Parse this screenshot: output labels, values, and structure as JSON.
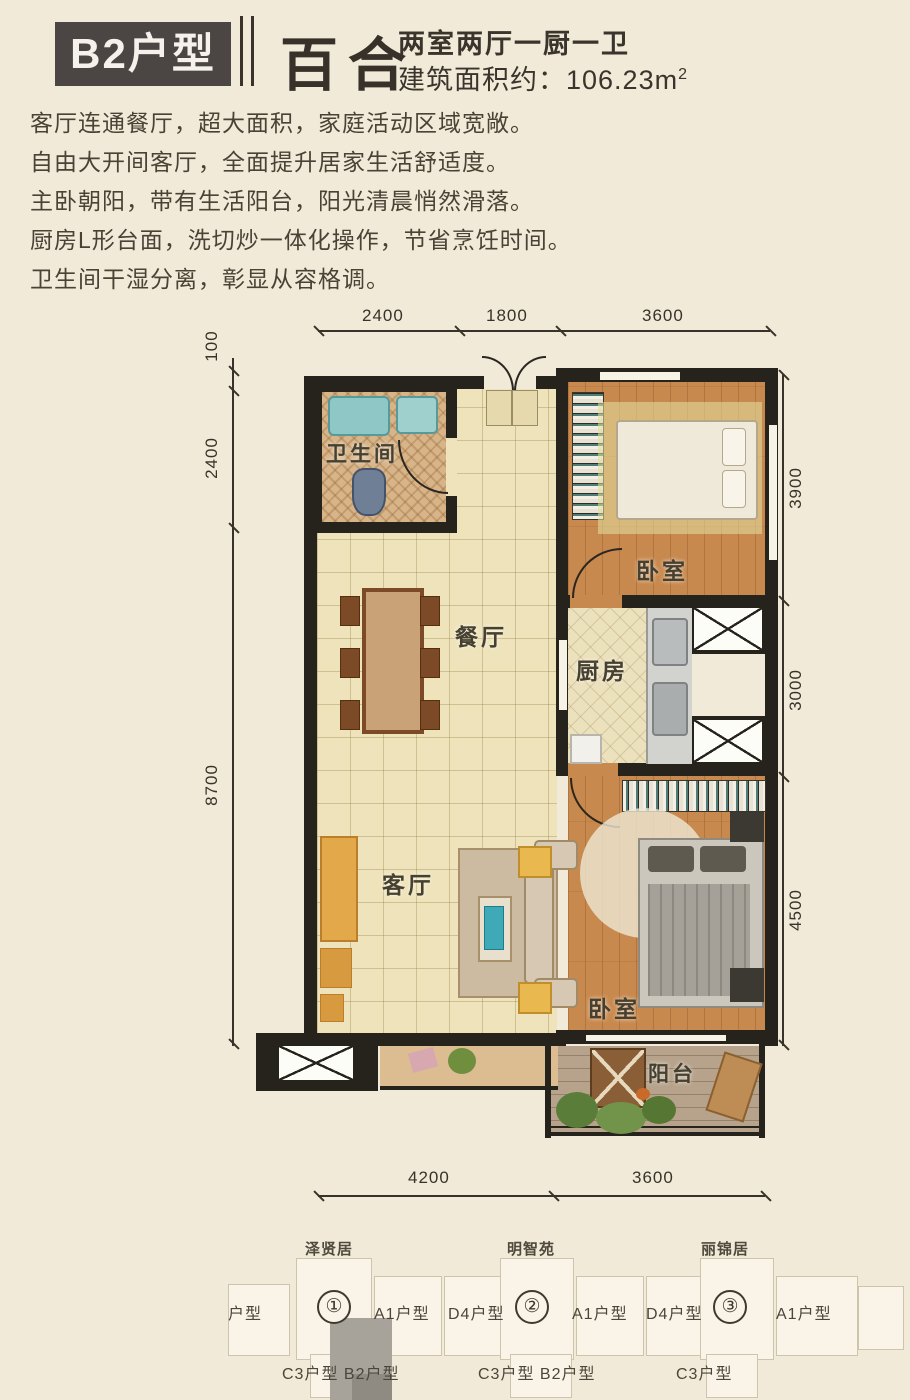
{
  "header": {
    "badge": "B2户型",
    "name": "百合",
    "spec": "两室两厅一厨一卫",
    "area_prefix": "建筑面积约：106.23m",
    "area_sup": "2"
  },
  "description": {
    "lines": [
      "客厅连通餐厅，超大面积，家庭活动区域宽敞。",
      "自由大开间客厅，全面提升居家生活舒适度。",
      "主卧朝阳，带有生活阳台，阳光清晨悄然滑落。",
      "厨房L形台面，洗切炒一体化操作，节省烹饪时间。",
      "卫生间干湿分离，彰显从容格调。"
    ]
  },
  "floorplan": {
    "rooms": {
      "bathroom": "卫生间",
      "dining": "餐厅",
      "kitchen": "厨房",
      "bedroom_top": "卧室",
      "living": "客厅",
      "bedroom_bottom": "卧室",
      "balcony": "阳台"
    },
    "dims": {
      "top": [
        "2400",
        "1800",
        "3600"
      ],
      "left": [
        "100",
        "2400",
        "8700"
      ],
      "right": [
        "3900",
        "3000",
        "4500"
      ],
      "bottom": [
        "4200",
        "3600"
      ]
    }
  },
  "keyplan": {
    "building_names": [
      "泽贤居",
      "明智苑",
      "丽锦居"
    ],
    "circles": [
      "①",
      "②",
      "③"
    ],
    "unit_row": [
      "户型",
      "A1户型",
      "D4户型",
      "A1户型",
      "D4户型",
      "A1户型"
    ],
    "bottom_labels": [
      "C3户型 B2户型",
      "C3户型 B2户型",
      "C3户型"
    ]
  },
  "colors": {
    "background": "#f1ead8",
    "wall": "#26221c",
    "wood_floor": "#c8894e",
    "tile_floor": "#eee3ba",
    "highlight_unit": "#a7a39b",
    "badge_bg": "#4b4643"
  }
}
